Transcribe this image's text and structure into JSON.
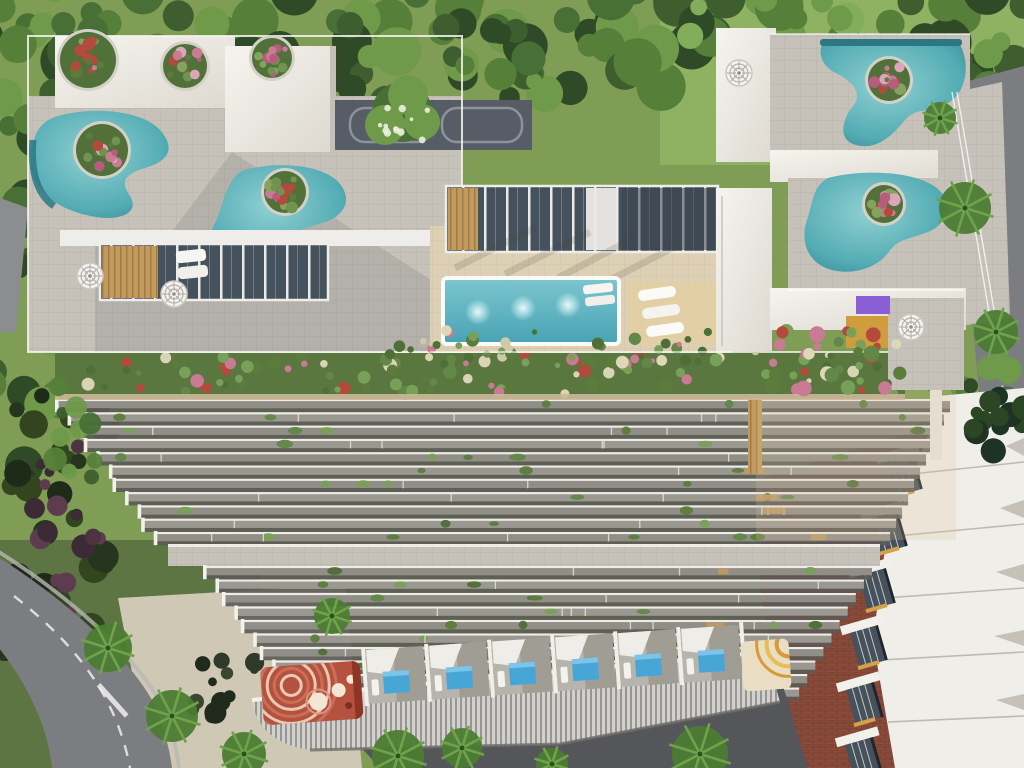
{
  "scene": {
    "title": "Aerial 3D rendering of a modern residential complex",
    "type": "architectural-render",
    "view": "top-down bird's-eye",
    "inventory": {
      "rooftop_freeform_pools": 4,
      "rooftop_courtyard_pool": 1,
      "ground_plunge_pool_units": 6,
      "spiral_staircases": 4,
      "rooftop_flower_planters": 7,
      "murals": [
        "red-concentric-circles",
        "yellow-arcs"
      ],
      "neighbor_building": "white stepped slabs with glass balconies",
      "landscape": [
        "trees",
        "palm trees",
        "lawn",
        "curved road",
        "straight road",
        "terracotta pavement",
        "sand plaza"
      ]
    },
    "palette": {
      "lawn": "#7f9d54",
      "lawn-light": "#8fb162",
      "tree": "#567f3a",
      "tree-dark": "#3e5e2f",
      "tree-light": "#6f9a4a",
      "shrub-dark": "#26351d",
      "shrub-purple": "#4e3442",
      "road": "#7b7d80",
      "road-dark": "#55565a",
      "road-line": "#e8e8e6",
      "plaza-sand": "#cfc8b4",
      "terracotta": "#8b4b3a",
      "roof-white": "#f0eee8",
      "roof-shade": "#d7d4cc",
      "pavers": "#c6c2ba",
      "pavers-shade": "#b0aca4",
      "pool-teal": "#62b7bc",
      "pool-deep": "#3a95a0",
      "pool-edge": "#2b7884",
      "plunge-blue": "#47a6d6",
      "deck-beige": "#ddd0b5",
      "slab-gray": "#98958f",
      "slab-fascia": "#edece8",
      "slab-shadow": "#5b5a56",
      "wood": "#c39a5e",
      "glass-dark": "#45515c",
      "mural-red": "#b5523f",
      "mural-salmon": "#d78f7a",
      "mural-cream": "#f2e7d4",
      "gold": "#cf9c3e",
      "purple": "#8a5fd6",
      "flower-pink": "#c97b93",
      "flower-red": "#b44a3c",
      "flower-cream": "#ded8b8"
    }
  }
}
